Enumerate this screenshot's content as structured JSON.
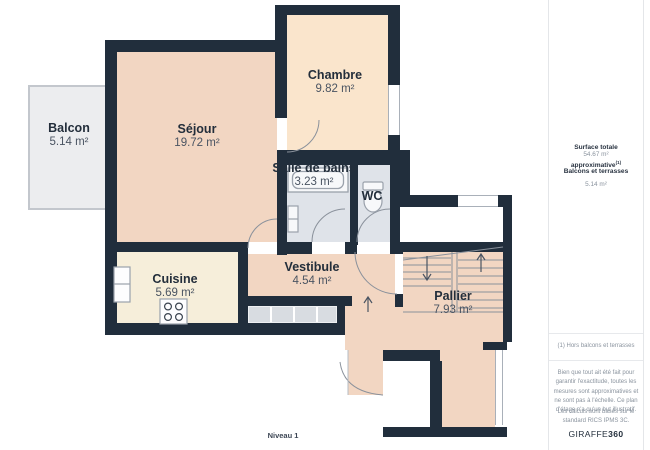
{
  "plan": {
    "level_label": "Niveau 1",
    "rooms": [
      {
        "name": "Balcon",
        "area": "5.14 m²"
      },
      {
        "name": "Séjour",
        "area": "19.72 m²"
      },
      {
        "name": "Chambre",
        "area": "9.82 m²"
      },
      {
        "name": "Salle de bains",
        "area": "3.23 m²"
      },
      {
        "name": "WC",
        "area": ""
      },
      {
        "name": "Cuisine",
        "area": "5.69 m²"
      },
      {
        "name": "Vestibule",
        "area": "4.54 m²"
      },
      {
        "name": "Pallier",
        "area": "7.93 m²"
      }
    ]
  },
  "sidebar": {
    "total_label": "Surface totale approximative",
    "total_superscript": "(1)",
    "total_value": "54.67 m²",
    "balconies_label": "Balcons et terrasses",
    "balconies_value": "5.14 m²",
    "footnote": "(1) Hors balcons et terrasses",
    "disclaimer": "Bien que tout ait été fait pour garantir l'exactitude, toutes les mesures sont approximatives et ne sont pas à l'échelle. Ce plan d'étage n'a qu'un but illustratif.",
    "standard_note": "Les calculs sont basés sur le standard RICS IPMS 3C.",
    "brand_regular": "GIRAFFE",
    "brand_bold": "360"
  },
  "colors": {
    "wall": "#212e3c",
    "room_warm": "#f2d6c2",
    "room_warm_light": "#fae5cc",
    "room_wet": "#dfe3e9",
    "room_cream": "#f6eeda",
    "balcony": "#ecedef",
    "entry_mat": "#d8dce1",
    "line": "#8a919b",
    "text_dark": "#232e3b",
    "text_muted": "#8a939e"
  }
}
